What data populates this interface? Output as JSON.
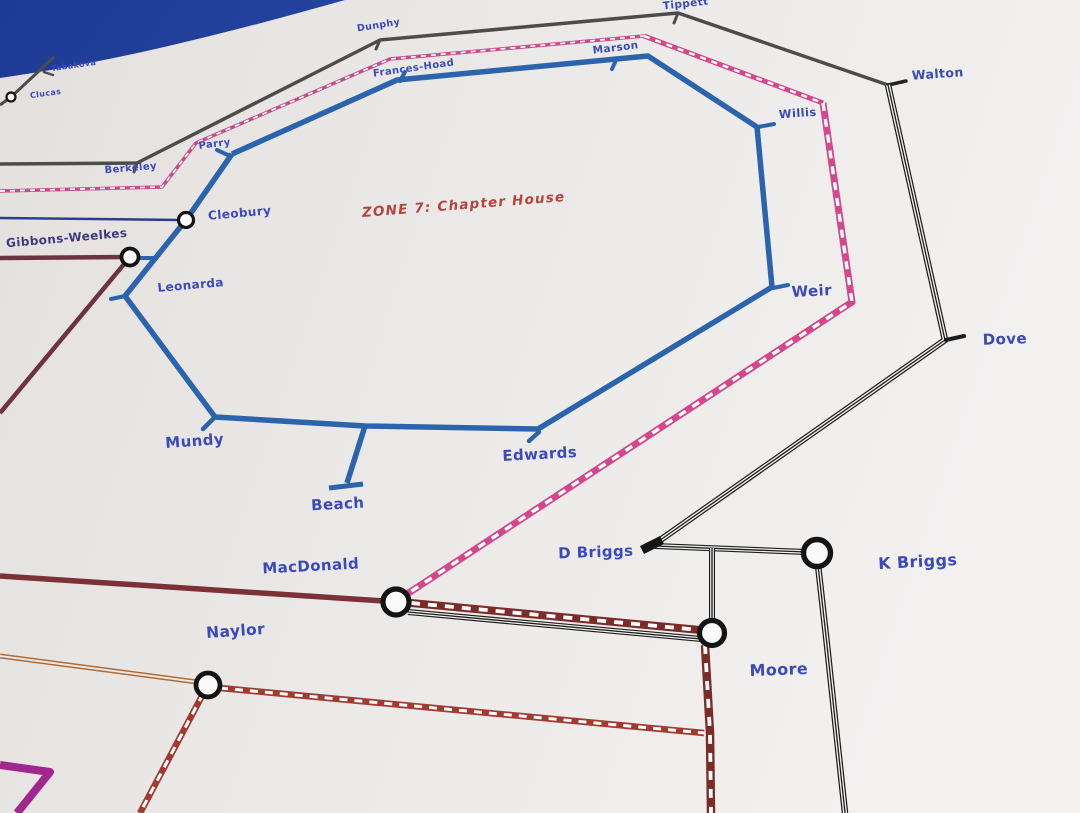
{
  "photo": {
    "background_color": "#1d3a94",
    "background_color_light": "#3b5cc0",
    "paper_color_left": "#e3e0de",
    "paper_color_mid": "#ebe9e7",
    "paper_color_right": "#f2f1f0",
    "label_color": "#3a49bd",
    "ring_color": "#141414",
    "circle_fill": "#fbfafa"
  },
  "zone_label": {
    "text": "ZONE 7: Chapter House",
    "x": 464,
    "y": 209,
    "rotation": -4.5,
    "size": 13.5,
    "color": "#b5443e"
  },
  "map": {
    "lines": [
      {
        "id": "clucas-branch",
        "style": "solid",
        "color": "#4c4c4c",
        "w": 3,
        "points": [
          [
            54,
            57
          ],
          [
            11,
            97
          ],
          [
            0,
            105
          ]
        ]
      },
      {
        "id": "tabakova-tick",
        "style": "solid",
        "color": "#4c4c4c",
        "w": 2.5,
        "cap": "round",
        "points": [
          [
            44,
            72
          ],
          [
            53,
            75
          ]
        ]
      },
      {
        "id": "berkeley-tippett-walton",
        "style": "solid",
        "color": "#4c4c4c",
        "w": 3.5,
        "points": [
          [
            0,
            164
          ],
          [
            137,
            163
          ],
          [
            380,
            40
          ],
          [
            678,
            13
          ],
          [
            888,
            85
          ]
        ]
      },
      {
        "id": "berkeley-tick",
        "style": "solid",
        "color": "#4c4c4c",
        "w": 3,
        "cap": "round",
        "points": [
          [
            137,
            163
          ],
          [
            134,
            172
          ]
        ]
      },
      {
        "id": "dunphy-tick",
        "style": "solid",
        "color": "#4c4c4c",
        "w": 3,
        "cap": "round",
        "points": [
          [
            380,
            40
          ],
          [
            376,
            49
          ]
        ]
      },
      {
        "id": "tippett-tick",
        "style": "solid",
        "color": "#4c4c4c",
        "w": 3,
        "cap": "round",
        "points": [
          [
            678,
            13
          ],
          [
            674,
            23
          ]
        ]
      },
      {
        "id": "walton-tick",
        "style": "solid",
        "color": "#222222",
        "w": 3.5,
        "cap": "round",
        "points": [
          [
            888,
            85
          ],
          [
            906,
            81
          ]
        ]
      },
      {
        "id": "cleobury-feeder",
        "style": "solid",
        "color": "#2a3f8c",
        "w": 2.5,
        "points": [
          [
            0,
            218
          ],
          [
            180,
            220
          ]
        ]
      },
      {
        "id": "gibbons-weelkes-maroon",
        "style": "solid",
        "color": "#6d3342",
        "w": 4.5,
        "points": [
          [
            0,
            258
          ],
          [
            130,
            257
          ],
          [
            0,
            413
          ]
        ]
      },
      {
        "id": "gibbons-weelkes-stub",
        "style": "solid",
        "color": "#2b64ad",
        "w": 4,
        "points": [
          [
            138,
            258
          ],
          [
            158,
            258
          ]
        ]
      },
      {
        "id": "macdonald-maroon",
        "style": "solid",
        "color": "#7c3136",
        "w": 5.5,
        "points": [
          [
            0,
            576
          ],
          [
            384,
            601
          ]
        ]
      },
      {
        "id": "pink-route-west",
        "style": "dash",
        "color": "#c94b8c",
        "w": 3.5,
        "core": 1.7,
        "dashpat": "5 5",
        "points": [
          [
            0,
            191
          ],
          [
            162,
            187
          ],
          [
            196,
            143
          ],
          [
            390,
            59
          ],
          [
            644,
            36
          ]
        ]
      },
      {
        "id": "pink-route-north",
        "style": "dash",
        "color": "#d4478d",
        "w": 5,
        "core": 2.4,
        "dashpat": "6 6",
        "points": [
          [
            644,
            36
          ],
          [
            823,
            103
          ]
        ]
      },
      {
        "id": "pink-route-east",
        "style": "dash",
        "color": "#d4478d",
        "w": 7,
        "core": 3.4,
        "dashpat": "8 8",
        "points": [
          [
            823,
            103
          ],
          [
            852,
            302
          ],
          [
            404,
            596
          ]
        ]
      },
      {
        "id": "zone7-loop",
        "style": "solid",
        "color": "#2b64ad",
        "w": 5.5,
        "points": [
          [
            232,
            154
          ],
          [
            397,
            80
          ],
          [
            648,
            56
          ],
          [
            757,
            127
          ],
          [
            772,
            287
          ],
          [
            538,
            429
          ],
          [
            365,
            426
          ],
          [
            215,
            417
          ],
          [
            125,
            296
          ],
          [
            186,
            220
          ],
          [
            232,
            154
          ]
        ]
      },
      {
        "id": "beach-spur",
        "style": "solid",
        "color": "#2b64ad",
        "w": 5.5,
        "points": [
          [
            365,
            426
          ],
          [
            347,
            483
          ]
        ]
      },
      {
        "id": "beach-terminus-bar",
        "style": "solid",
        "color": "#2b64ad",
        "w": 5,
        "points": [
          [
            329,
            488
          ],
          [
            363,
            484
          ]
        ]
      },
      {
        "id": "parry-tick",
        "style": "solid",
        "color": "#2b64ad",
        "w": 4,
        "cap": "round",
        "points": [
          [
            230,
            156
          ],
          [
            217,
            150
          ]
        ]
      },
      {
        "id": "frances-hoad-tick",
        "style": "solid",
        "color": "#2b64ad",
        "w": 4,
        "cap": "round",
        "points": [
          [
            400,
            81
          ],
          [
            405,
            72
          ]
        ]
      },
      {
        "id": "marson-tick",
        "style": "solid",
        "color": "#2b64ad",
        "w": 4,
        "cap": "round",
        "points": [
          [
            616,
            60
          ],
          [
            612,
            69
          ]
        ]
      },
      {
        "id": "willis-tick",
        "style": "solid",
        "color": "#2b64ad",
        "w": 4,
        "cap": "round",
        "points": [
          [
            758,
            127
          ],
          [
            774,
            124
          ]
        ]
      },
      {
        "id": "weir-tick",
        "style": "solid",
        "color": "#2b64ad",
        "w": 4,
        "cap": "round",
        "points": [
          [
            773,
            288
          ],
          [
            788,
            285
          ]
        ]
      },
      {
        "id": "leonarda-tick",
        "style": "solid",
        "color": "#2b64ad",
        "w": 4,
        "cap": "round",
        "points": [
          [
            125,
            296
          ],
          [
            111,
            299
          ]
        ]
      },
      {
        "id": "mundy-tick",
        "style": "solid",
        "color": "#2b64ad",
        "w": 4.5,
        "cap": "round",
        "points": [
          [
            215,
            417
          ],
          [
            203,
            429
          ]
        ]
      },
      {
        "id": "edwards-tick",
        "style": "solid",
        "color": "#2b64ad",
        "w": 4.5,
        "cap": "round",
        "points": [
          [
            539,
            432
          ],
          [
            529,
            441
          ]
        ]
      },
      {
        "id": "walton-dove-dbriggs-black",
        "style": "triple",
        "color": "#1c1c1c",
        "w": 6.5,
        "points": [
          [
            888,
            85
          ],
          [
            945,
            340
          ],
          [
            656,
            543
          ]
        ]
      },
      {
        "id": "dove-tick",
        "style": "solid",
        "color": "#1c1c1c",
        "w": 4,
        "cap": "round",
        "points": [
          [
            946,
            340
          ],
          [
            964,
            336
          ]
        ]
      },
      {
        "id": "dbriggs-kbriggs-black",
        "style": "triple",
        "color": "#1c1c1c",
        "w": 6,
        "points": [
          [
            655,
            546
          ],
          [
            806,
            552
          ]
        ]
      },
      {
        "id": "dbriggs-moore-black",
        "style": "triple",
        "color": "#1c1c1c",
        "w": 6,
        "points": [
          [
            712,
            548
          ],
          [
            712,
            624
          ]
        ]
      },
      {
        "id": "kbriggs-south-black",
        "style": "triple",
        "color": "#1c1c1c",
        "w": 6.5,
        "points": [
          [
            818,
            565
          ],
          [
            827,
            645
          ],
          [
            845,
            813
          ]
        ]
      },
      {
        "id": "macdonald-moore-black",
        "style": "triple",
        "color": "#1c1c1c",
        "w": 6,
        "points": [
          [
            408,
            612
          ],
          [
            701,
            639
          ]
        ]
      },
      {
        "id": "macdonald-moore-maroon-dash",
        "style": "dash",
        "color": "#7b2b28",
        "w": 8,
        "core": 3.8,
        "dashpat": "9 8",
        "points": [
          [
            411,
            603
          ],
          [
            700,
            630
          ]
        ]
      },
      {
        "id": "moore-south-maroon-dash",
        "style": "dash",
        "color": "#7b2b28",
        "w": 8.5,
        "core": 3.8,
        "dashpat": "9 9",
        "points": [
          [
            705,
            645
          ],
          [
            710,
            733
          ],
          [
            711,
            813
          ]
        ]
      },
      {
        "id": "naylor-east-red-dash",
        "style": "dash",
        "color": "#a23a31",
        "w": 6.5,
        "core": 3,
        "dashpat": "8 7",
        "points": [
          [
            220,
            688
          ],
          [
            704,
            733
          ]
        ]
      },
      {
        "id": "naylor-south-red-dash",
        "style": "dash",
        "color": "#a23a31",
        "w": 6.5,
        "core": 3,
        "dashpat": "8 7",
        "points": [
          [
            203,
            694
          ],
          [
            140,
            813
          ]
        ]
      },
      {
        "id": "naylor-orange-double",
        "style": "double",
        "color": "#b06a35",
        "w": 5,
        "core": 2,
        "corecolor": "#ebe9e7",
        "points": [
          [
            0,
            656
          ],
          [
            197,
            682
          ]
        ]
      },
      {
        "id": "purple-corner",
        "style": "solid",
        "color": "#a1278f",
        "w": 8,
        "points": [
          [
            0,
            765
          ],
          [
            50,
            772
          ],
          [
            17,
            813
          ]
        ]
      },
      {
        "id": "dbriggs-terminus-wedge",
        "style": "solid",
        "color": "#151515",
        "w": 9,
        "points": [
          [
            642,
            550
          ],
          [
            662,
            540
          ]
        ]
      }
    ],
    "interchanges": [
      {
        "station": "Clucas",
        "x": 11,
        "y": 97,
        "r": 4.5,
        "ring": 2.2
      },
      {
        "station": "Cleobury",
        "x": 186,
        "y": 220,
        "r": 7.5,
        "ring": 3.2
      },
      {
        "station": "Gibbons-Weelkes",
        "x": 130,
        "y": 257,
        "r": 8.5,
        "ring": 3.8
      },
      {
        "station": "MacDonald",
        "x": 396,
        "y": 602,
        "r": 13,
        "ring": 5.2
      },
      {
        "station": "Naylor",
        "x": 208,
        "y": 685,
        "r": 12,
        "ring": 4.8
      },
      {
        "station": "Moore",
        "x": 712,
        "y": 633,
        "r": 12.5,
        "ring": 5.2
      },
      {
        "station": "K Briggs",
        "x": 817,
        "y": 553,
        "r": 13.5,
        "ring": 5.4
      }
    ],
    "stations": [
      {
        "name": "Tabakova",
        "x": 74,
        "y": 68,
        "size": 8,
        "rot": -8
      },
      {
        "name": "Clucas",
        "x": 46,
        "y": 96,
        "size": 8,
        "rot": -8
      },
      {
        "name": "Berkeley",
        "x": 131,
        "y": 171,
        "size": 10,
        "rot": -5
      },
      {
        "name": "Dunphy",
        "x": 379,
        "y": 28,
        "size": 9.5,
        "rot": -9
      },
      {
        "name": "Tippett",
        "x": 686,
        "y": 7,
        "size": 10.5,
        "rot": -6
      },
      {
        "name": "Walton",
        "x": 938,
        "y": 78,
        "size": 12.5,
        "rot": -4
      },
      {
        "name": "Frances-Hoad",
        "x": 414,
        "y": 71,
        "size": 10,
        "rot": -8
      },
      {
        "name": "Marson",
        "x": 616,
        "y": 51,
        "size": 10.5,
        "rot": -7
      },
      {
        "name": "Parry",
        "x": 215,
        "y": 147,
        "size": 10,
        "rot": -7
      },
      {
        "name": "Cleobury",
        "x": 240,
        "y": 217,
        "size": 12,
        "rot": -5
      },
      {
        "name": "Gibbons-Weelkes",
        "x": 67,
        "y": 242,
        "size": 12,
        "rot": -5,
        "color": "#3f3a80"
      },
      {
        "name": "Leonarda",
        "x": 191,
        "y": 289,
        "size": 12,
        "rot": -5
      },
      {
        "name": "Willis",
        "x": 798,
        "y": 117,
        "size": 11.5,
        "rot": -4
      },
      {
        "name": "Weir",
        "x": 812,
        "y": 296,
        "size": 15,
        "rot": -3
      },
      {
        "name": "Mundy",
        "x": 195,
        "y": 446,
        "size": 15,
        "rot": -4
      },
      {
        "name": "Beach",
        "x": 338,
        "y": 509,
        "size": 15,
        "rot": -3
      },
      {
        "name": "Edwards",
        "x": 540,
        "y": 459,
        "size": 15,
        "rot": -3
      },
      {
        "name": "MacDonald",
        "x": 311,
        "y": 571,
        "size": 15,
        "rot": -3
      },
      {
        "name": "Naylor",
        "x": 236,
        "y": 636,
        "size": 15.5,
        "rot": -4
      },
      {
        "name": "D Briggs",
        "x": 596,
        "y": 557,
        "size": 15,
        "rot": -2
      },
      {
        "name": "K Briggs",
        "x": 918,
        "y": 567,
        "size": 16,
        "rot": -3
      },
      {
        "name": "Moore",
        "x": 779,
        "y": 675,
        "size": 16,
        "rot": -2
      },
      {
        "name": "Dove",
        "x": 1005,
        "y": 344,
        "size": 15,
        "rot": -2
      }
    ]
  }
}
